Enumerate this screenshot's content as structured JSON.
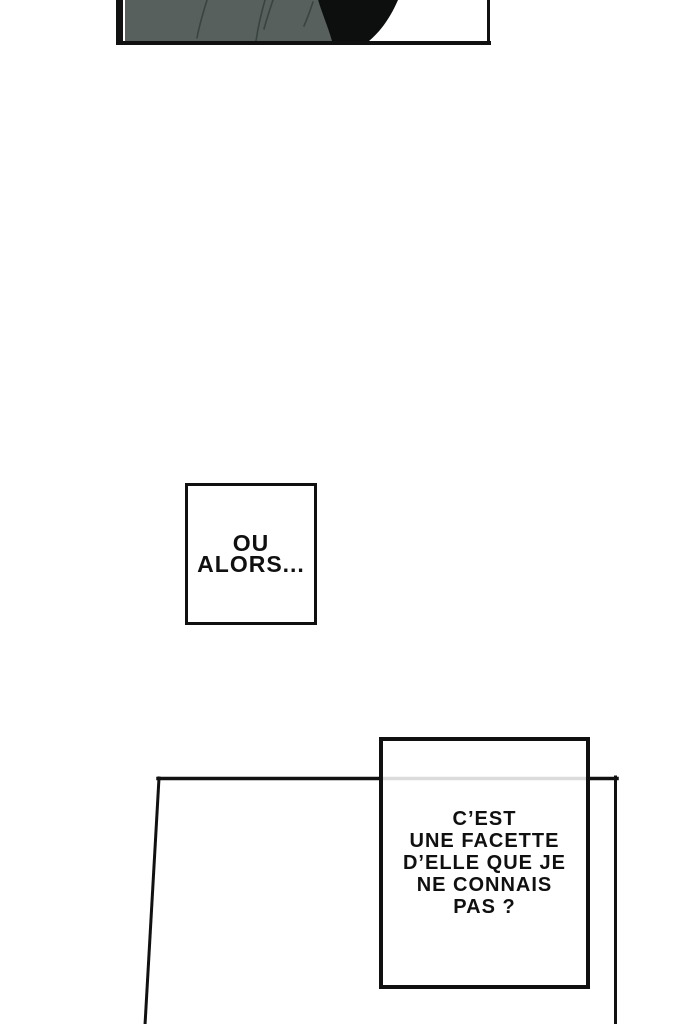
{
  "page": {
    "background": "#ffffff",
    "ink": "#111111"
  },
  "top_panel": {
    "fabric_color": "#57605d",
    "fold_color": "#39433f",
    "shadow_color": "#0d0e0e"
  },
  "speech_boxes": {
    "box1": {
      "text": "OU\nALORS..."
    },
    "box2": {
      "text": "C’EST\nUNE FACETTE\nD’ELLE QUE JE\nNE CONNAIS\nPAS ?"
    }
  }
}
